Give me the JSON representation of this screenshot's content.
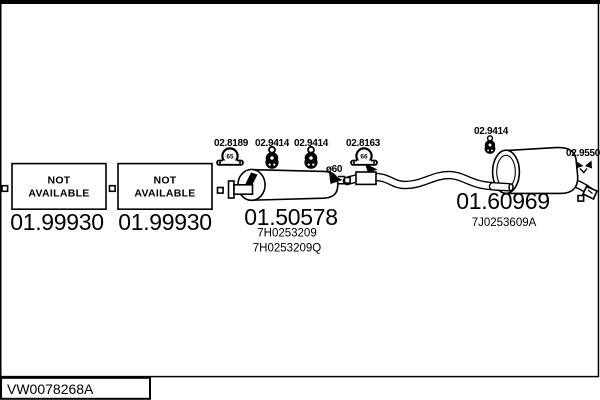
{
  "colors": {
    "line": "#000000",
    "background": "#ffffff"
  },
  "footer": {
    "code": "VW0078268A"
  },
  "left_boxes": [
    {
      "status_line1": "NOT",
      "status_line2": "AVAILABLE",
      "code": "01.99930"
    },
    {
      "status_line1": "NOT",
      "status_line2": "AVAILABLE",
      "code": "01.99930"
    }
  ],
  "middle_muffler": {
    "code": "01.50578",
    "part_numbers": [
      "7H0253209",
      "7H0253209Q"
    ],
    "diameter_label": "ø60"
  },
  "rear_muffler": {
    "code": "01.60969",
    "part_number": "7J0253609A"
  },
  "callouts": {
    "clamp_front": {
      "code": "02.8189",
      "size": "65"
    },
    "hanger_mid_1": {
      "code": "02.9414"
    },
    "hanger_mid_2": {
      "code": "02.9414"
    },
    "clamp_mid": {
      "code": "02.8163",
      "size": "66"
    },
    "hanger_rear": {
      "code": "02.9414"
    },
    "tail_tip": {
      "code": "02.9550"
    }
  }
}
